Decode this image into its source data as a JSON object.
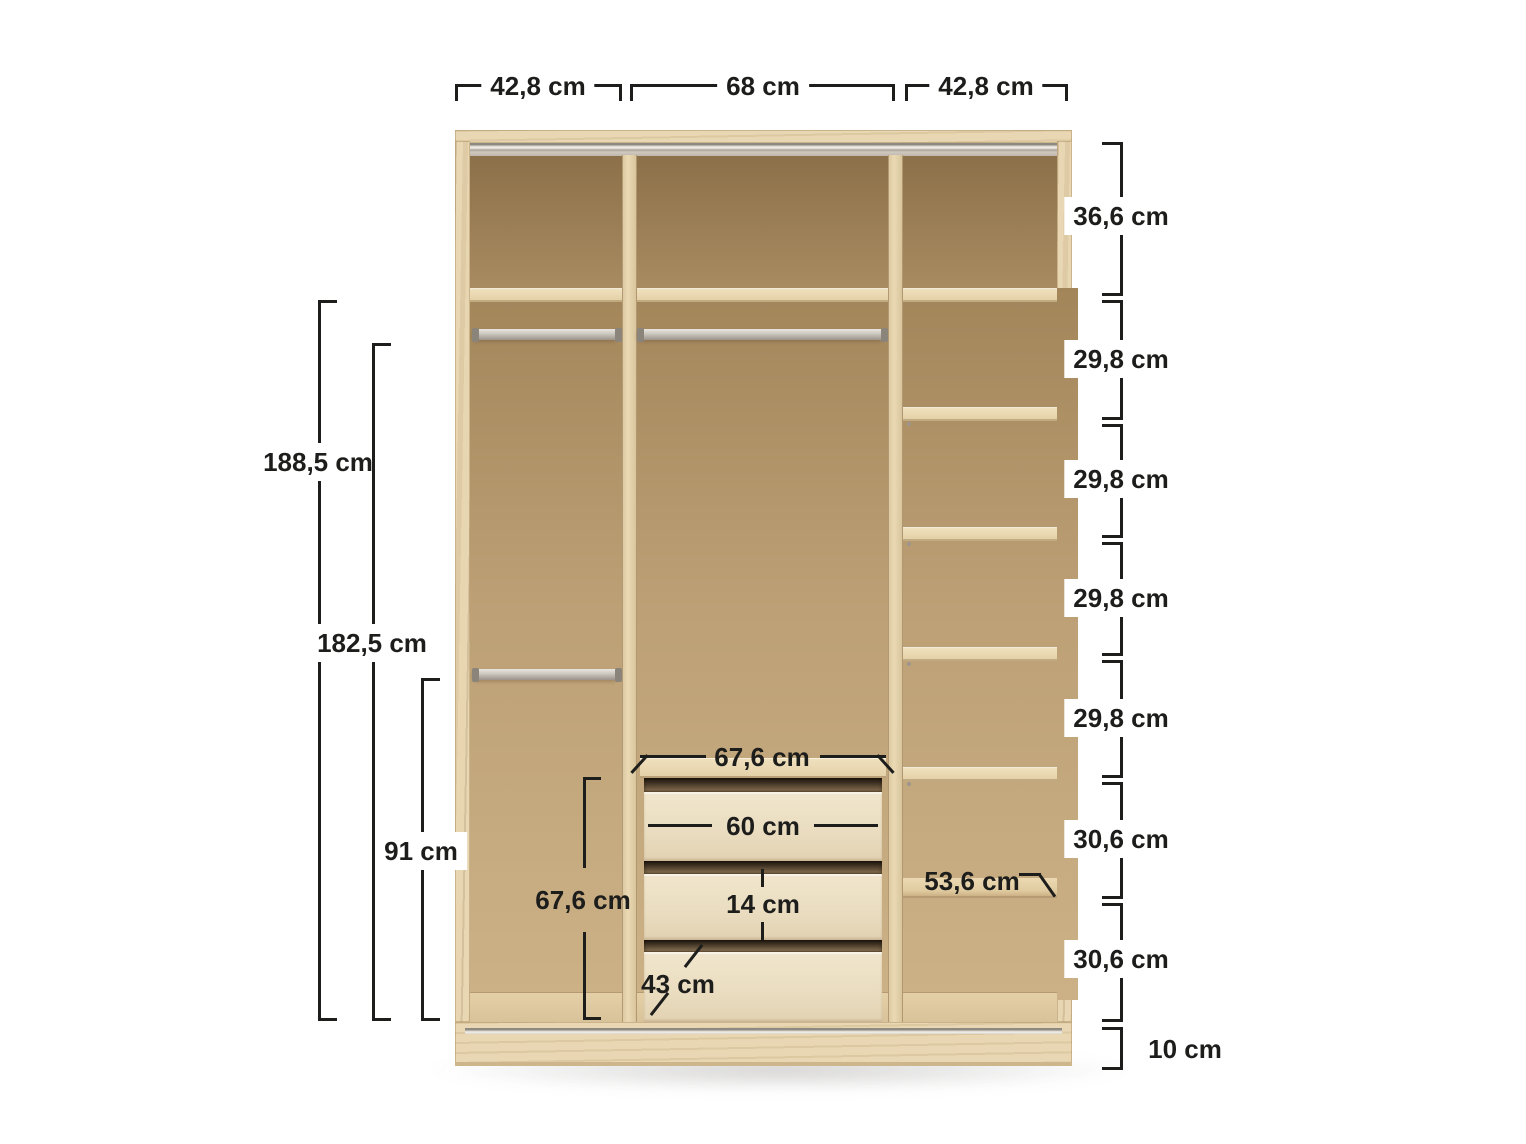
{
  "diagram_title": "wardrobe-interior-dimension-diagram",
  "dims": {
    "top": [
      "42,8 cm",
      "68 cm",
      "42,8 cm"
    ],
    "right": [
      "36,6 cm",
      "29,8 cm",
      "29,8 cm",
      "29,8 cm",
      "29,8 cm",
      "30,6 cm",
      "30,6 cm",
      "10 cm"
    ],
    "left": [
      "188,5 cm",
      "182,5 cm",
      "91 cm"
    ],
    "inner": {
      "drawer_top_width": "67,6 cm",
      "drawer_front_width": "60 cm",
      "drawer_inner_height": "14 cm",
      "drawer_depth": "43 cm",
      "drawer_zone_height": "67,6 cm",
      "shelf_width": "53,6 cm"
    }
  },
  "units": "cm",
  "colors": {
    "dimension_line": "#1d1d1b",
    "wood_edge_light": "#e7d5af",
    "wood_back_dark": "#8c7049",
    "wood_back_mid": "#bda075",
    "drawer_front": "#ecdfc4",
    "metal_rail": "#cfcac2",
    "background": "#ffffff"
  }
}
